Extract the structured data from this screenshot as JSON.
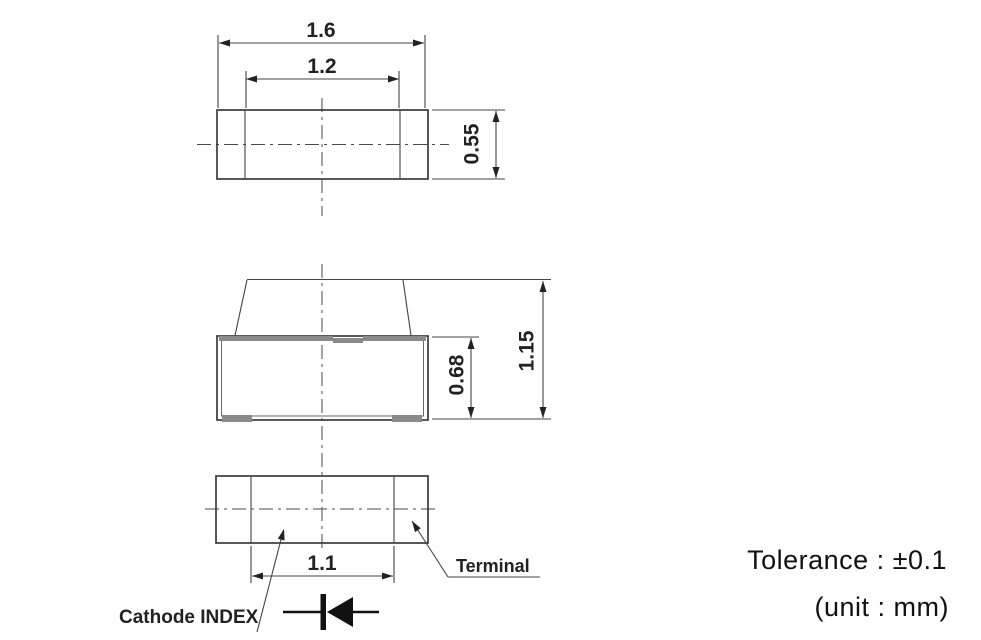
{
  "drawing": {
    "title_hint": "SMD LED package outline drawing",
    "dims": {
      "package_width": "1.6",
      "lens_width": "1.2",
      "package_depth": "0.55",
      "body_height": "0.68",
      "total_height": "1.15",
      "terminal_pitch": "1.1"
    },
    "labels": {
      "terminal": "Terminal",
      "cathode_index": "Cathode INDEX"
    },
    "notes": {
      "tolerance": "Tolerance : ±0.1",
      "unit": "(unit : mm)"
    },
    "colors": {
      "line": "#3c3c3c",
      "gray_fill": "#8a8a8a",
      "text": "#1a1a1a",
      "background": "#ffffff"
    }
  }
}
